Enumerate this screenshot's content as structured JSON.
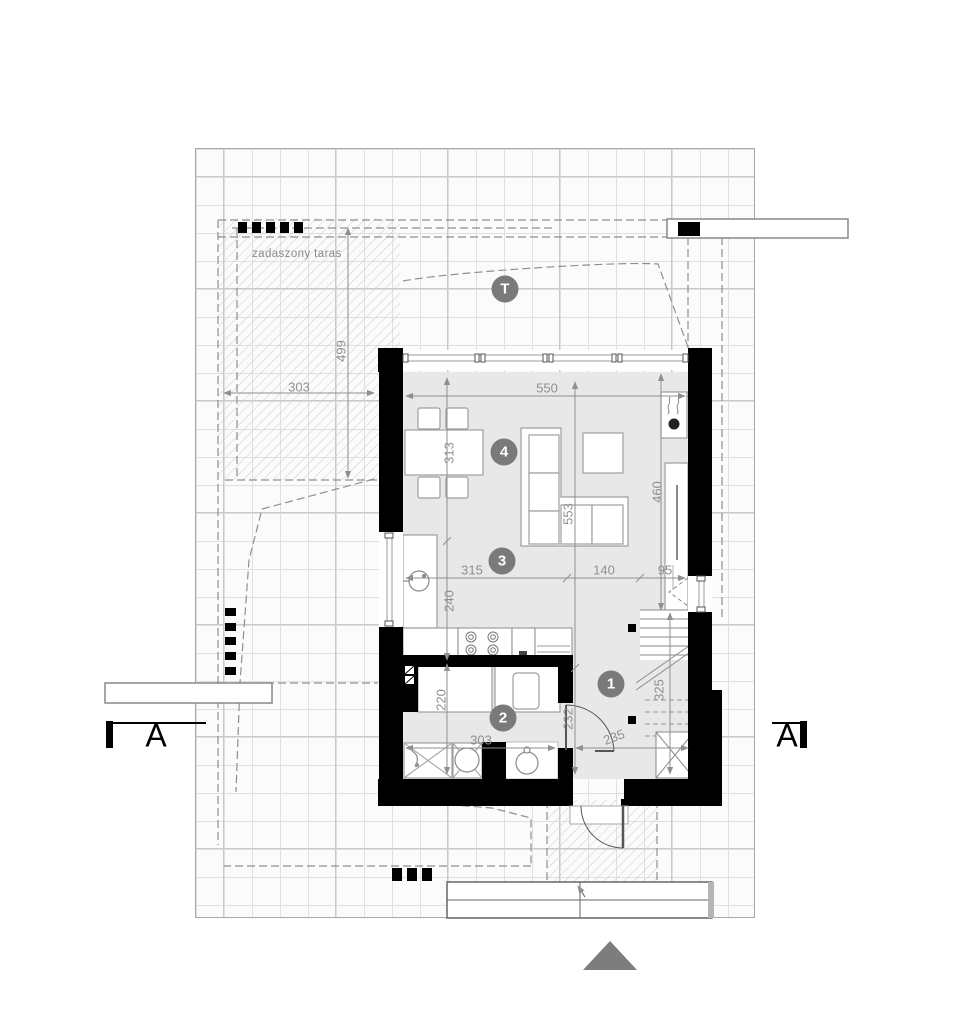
{
  "labels": {
    "terrace": "zadaszony taras",
    "section": "A"
  },
  "markers": {
    "terrace": "T",
    "living": "4",
    "kitchen": "3",
    "bathroom": "2",
    "hall": "1"
  },
  "dims": {
    "terrace_w": "303",
    "terrace_d": "499",
    "living_w": "550",
    "dining": "313",
    "kitchen_d": "240",
    "living_d": "553",
    "tv_wall": "460",
    "seg315": "315",
    "seg140": "140",
    "seg95": "95",
    "bath_w": "303",
    "bath_d": "220",
    "hall_d": "232",
    "stair_run": "325",
    "hall_w": "235"
  },
  "colors": {
    "wall": "#000000",
    "floor": "#e8e8e8",
    "dim_text": "#8f8f8f",
    "marker_bg": "#7a7a7a",
    "hatch": "#cccccc",
    "north_arrow": "#7d7d7d"
  }
}
